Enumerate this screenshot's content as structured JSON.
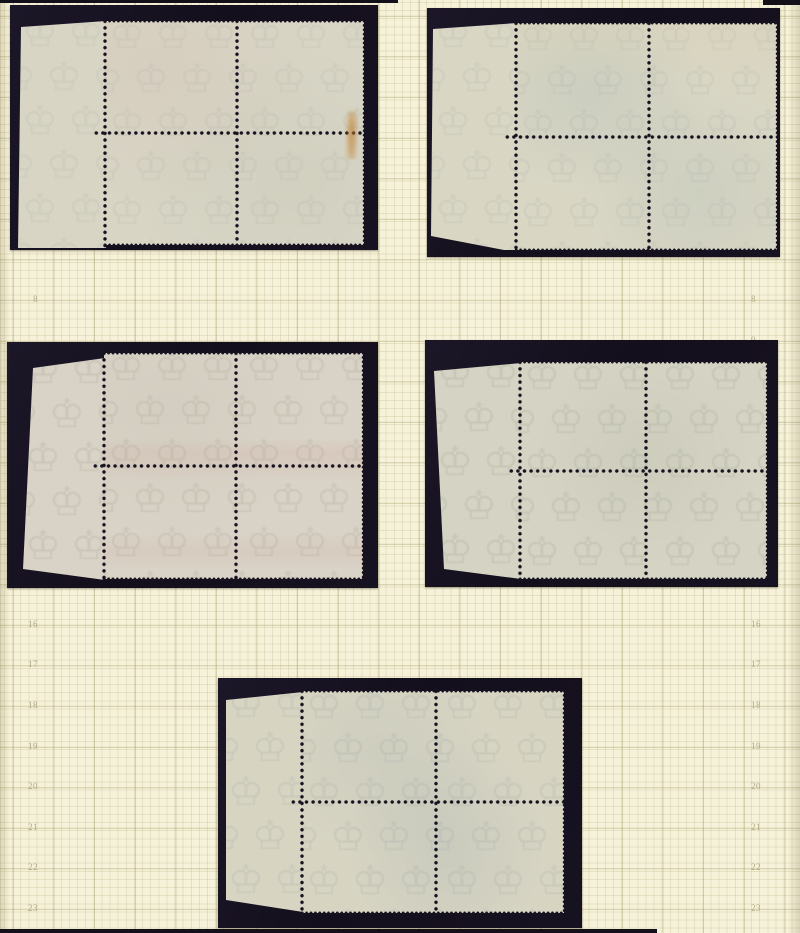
{
  "page": {
    "kind": "stamp-album-graph-paper-page",
    "watermark_glyph": "♔",
    "colors": {
      "page_bg": "#f6f2da",
      "grid_minor": "#ded9ba",
      "grid_major": "#cfc9a5",
      "row_number": "#a49d77",
      "mount": "#17121f",
      "stain": "#c17d2a"
    },
    "rows_left": [
      {
        "n": 8,
        "label": "8"
      },
      {
        "n": 16,
        "label": "16"
      },
      {
        "n": 17,
        "label": "17"
      },
      {
        "n": 18,
        "label": "18"
      },
      {
        "n": 19,
        "label": "19"
      },
      {
        "n": 20,
        "label": "20"
      },
      {
        "n": 21,
        "label": "21"
      },
      {
        "n": 22,
        "label": "22"
      },
      {
        "n": 23,
        "label": "23"
      }
    ],
    "rows_right": [
      {
        "n": 8,
        "label": "8"
      },
      {
        "n": 9,
        "label": "9"
      },
      {
        "n": 16,
        "label": "16"
      },
      {
        "n": 17,
        "label": "17"
      },
      {
        "n": 18,
        "label": "18"
      },
      {
        "n": 19,
        "label": "19"
      },
      {
        "n": 20,
        "label": "20"
      },
      {
        "n": 21,
        "label": "21"
      },
      {
        "n": 22,
        "label": "22"
      },
      {
        "n": 23,
        "label": "23"
      }
    ]
  },
  "blocks": [
    {
      "id": "block-1",
      "position": "top-left",
      "paper_color": "#d8d5c5",
      "watermark_color": "#8d958b",
      "watermark_opacity": 0.11,
      "has_stain": true
    },
    {
      "id": "block-2",
      "position": "top-right",
      "paper_color": "#d9d6c4",
      "watermark_color": "#7f8f96",
      "watermark_opacity": 0.11,
      "has_stain": false
    },
    {
      "id": "block-3",
      "position": "middle-left",
      "paper_color": "#d9d2c6",
      "watermark_color": "#869077",
      "watermark_opacity": 0.17,
      "has_stain": false
    },
    {
      "id": "block-4",
      "position": "middle-right",
      "paper_color": "#d5d3c3",
      "watermark_color": "#83907e",
      "watermark_opacity": 0.17,
      "has_stain": false
    },
    {
      "id": "block-5",
      "position": "bottom-center",
      "paper_color": "#d7d4c2",
      "watermark_color": "#7e8c92",
      "watermark_opacity": 0.14,
      "has_stain": false
    }
  ]
}
